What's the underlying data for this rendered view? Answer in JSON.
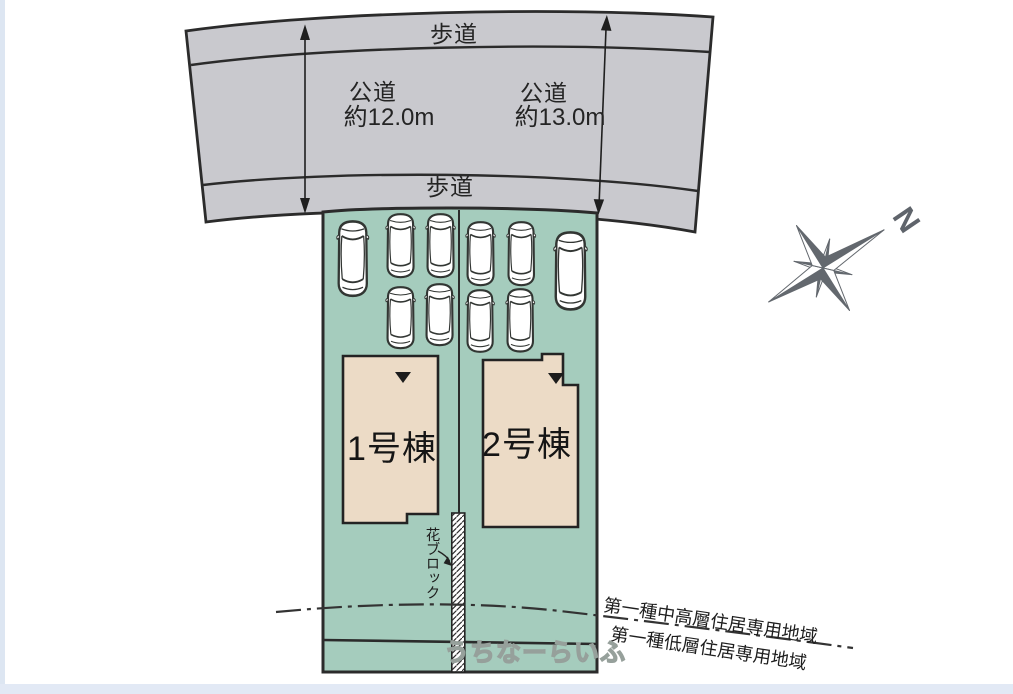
{
  "plan": {
    "road": {
      "sidewalk_top": "歩道",
      "sidewalk_bottom": "歩道",
      "left": {
        "name": "公道",
        "width": "約12.0m"
      },
      "right": {
        "name": "公道",
        "width": "約13.0m"
      }
    },
    "buildings": {
      "b1": {
        "label": "1号棟"
      },
      "b2": {
        "label": "2号棟"
      }
    },
    "flower_block": "花ブロック",
    "zoning": {
      "upper": "第一種中高層住居専用地域",
      "lower": "第一種低層住居専用地域"
    },
    "compass": {
      "north": "N"
    },
    "watermark": "うちなーらいふ",
    "parking": {
      "car_count": 10
    }
  },
  "colors": {
    "road_fill": "#c9c9ce",
    "lot_fill": "#a5ccbd",
    "building_fill": "#ecdbc6",
    "outline": "#2b2b2b",
    "compass_gray": "#63686e",
    "page_edge_blue": "#dde6f2"
  }
}
